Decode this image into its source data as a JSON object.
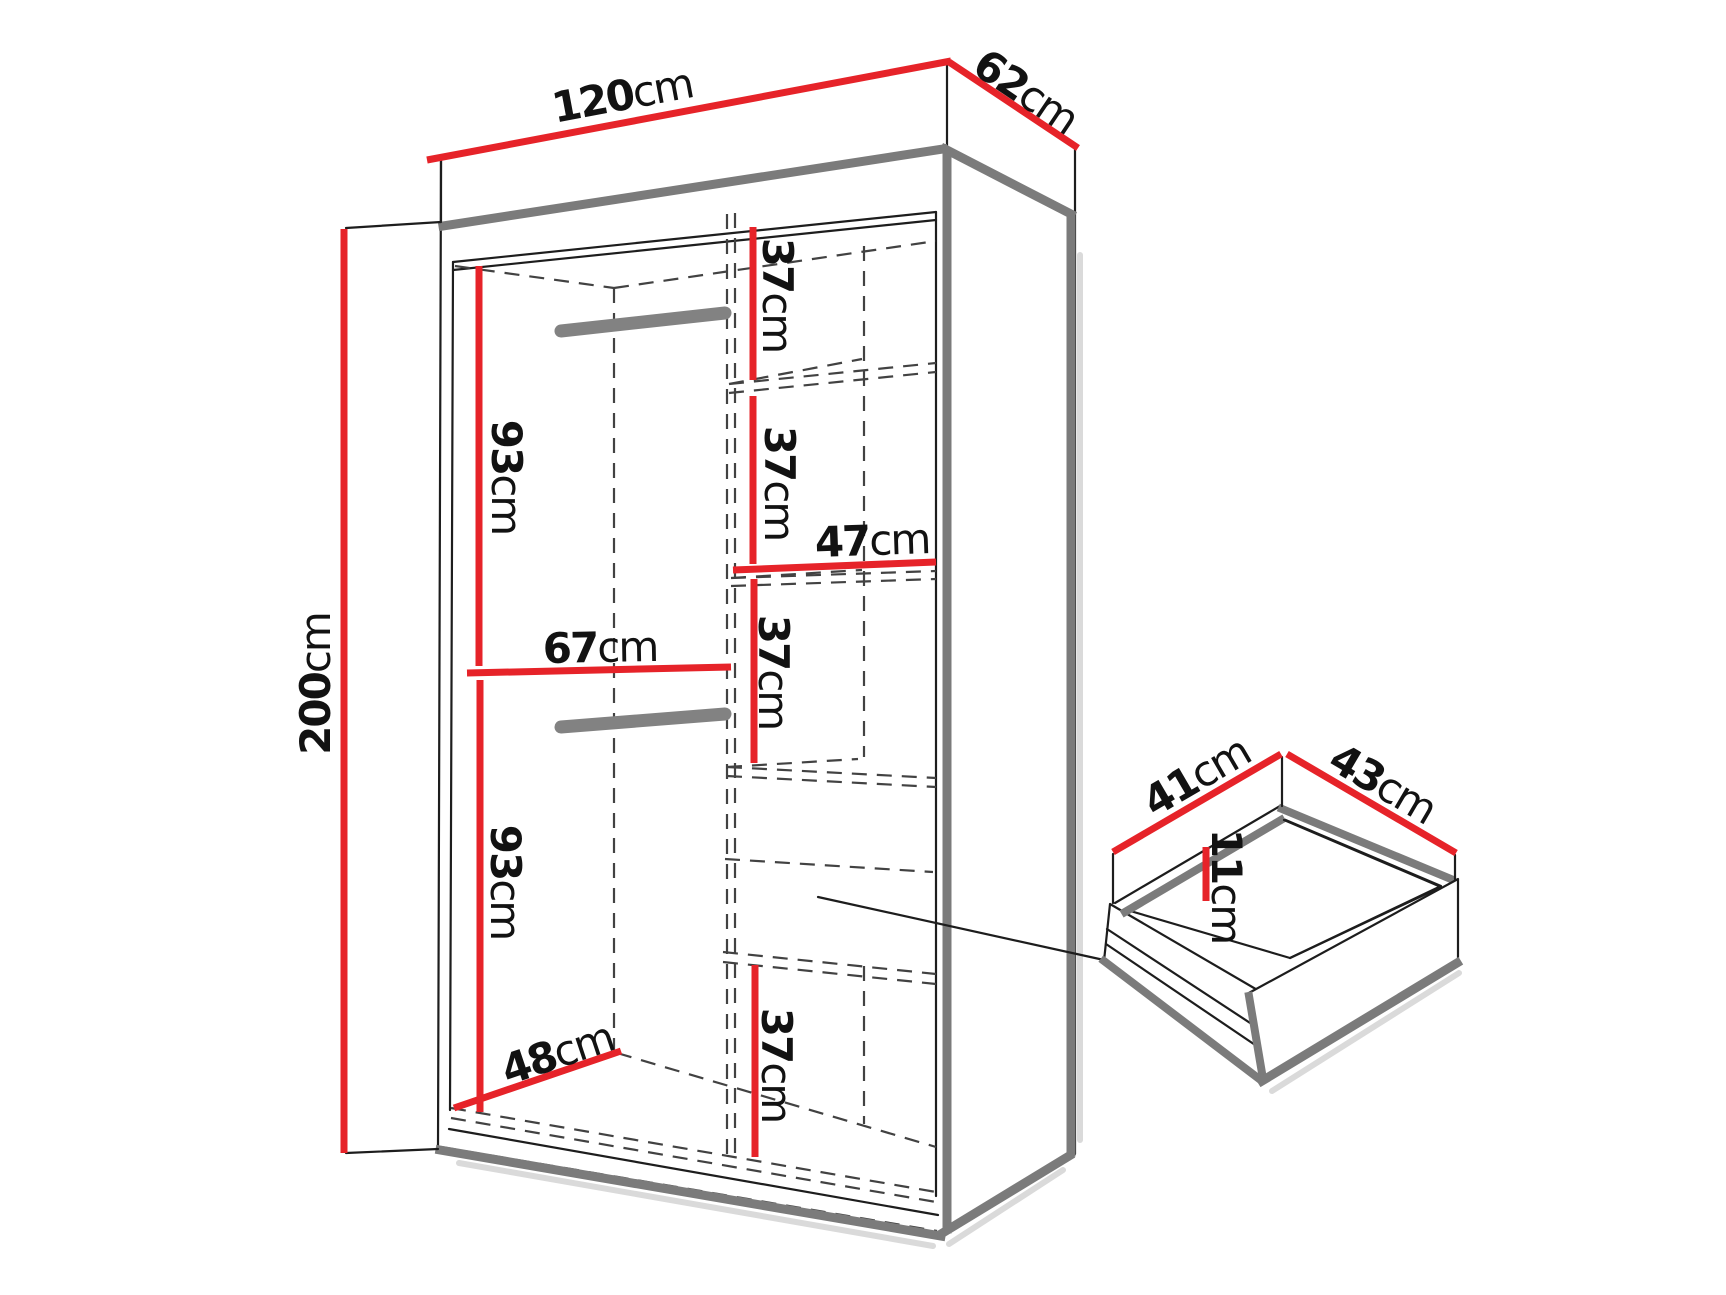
{
  "figure": {
    "kind": "wardrobe-dimension-diagram",
    "background": "#ffffff",
    "accent_color": "#e62329",
    "edge_shadow_color": "#7b7b7b"
  },
  "wardrobe": {
    "width": {
      "value": "120",
      "unit": "cm"
    },
    "depth": {
      "value": "62",
      "unit": "cm"
    },
    "height": {
      "value": "200",
      "unit": "cm"
    },
    "hanging_column": {
      "upper_section_height": {
        "value": "93",
        "unit": "cm"
      },
      "column_width": {
        "value": "67",
        "unit": "cm"
      },
      "lower_section_height": {
        "value": "93",
        "unit": "cm"
      },
      "interior_depth": {
        "value": "48",
        "unit": "cm"
      }
    },
    "shelf_column": {
      "shelf_spacing_1": {
        "value": "37",
        "unit": "cm"
      },
      "shelf_spacing_2": {
        "value": "37",
        "unit": "cm"
      },
      "shelf_width": {
        "value": "47",
        "unit": "cm"
      },
      "shelf_spacing_3": {
        "value": "37",
        "unit": "cm"
      },
      "shelf_spacing_4": {
        "value": "37",
        "unit": "cm"
      }
    }
  },
  "drawer": {
    "depth": {
      "value": "41",
      "unit": "cm"
    },
    "width": {
      "value": "43",
      "unit": "cm"
    },
    "inner_height": {
      "value": "11",
      "unit": "cm"
    }
  }
}
